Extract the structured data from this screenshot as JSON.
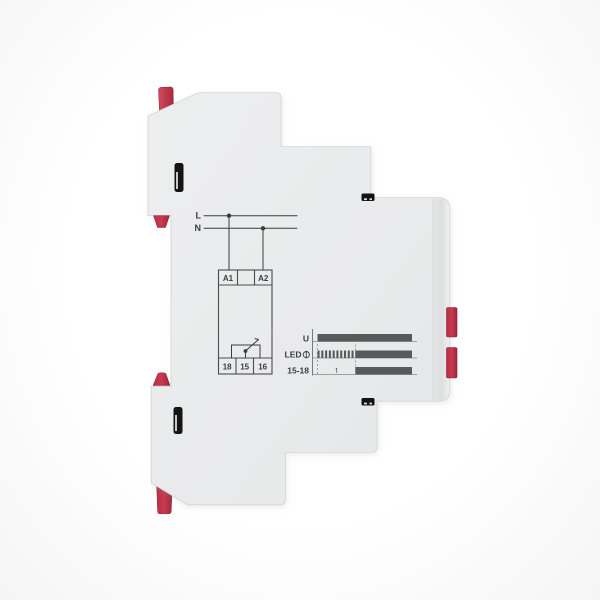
{
  "product": {
    "description_label": "",
    "colors": {
      "body_gray": "#e9eaeb",
      "edge_gray": "#dcdee0",
      "clip_red": "#c5304a",
      "ink": "#3a3c3e",
      "bar_gray": "#58595b",
      "slot_black": "#141414",
      "background": "#ffffff"
    }
  },
  "wiring": {
    "supply_lines": [
      {
        "label": "L"
      },
      {
        "label": "N"
      }
    ],
    "coil_terminals": [
      "A1",
      "A2"
    ],
    "contact_terminals": [
      "18",
      "15",
      "16"
    ]
  },
  "timing": {
    "rows": [
      {
        "label": "U",
        "icon": "",
        "segments": [
          {
            "state": "on",
            "from": 0,
            "to": 1
          }
        ]
      },
      {
        "label": "LED",
        "icon": "lamp-icon",
        "segments": [
          {
            "state": "blinking",
            "from": 0,
            "to": 0.4
          },
          {
            "state": "on",
            "from": 0.4,
            "to": 1
          }
        ]
      },
      {
        "label": "15-18",
        "icon": "",
        "segments": [
          {
            "state": "off",
            "from": 0,
            "to": 0.4
          },
          {
            "state": "on",
            "from": 0.4,
            "to": 1
          }
        ]
      }
    ],
    "delay_marker": "t",
    "blink_pulses": 10
  }
}
